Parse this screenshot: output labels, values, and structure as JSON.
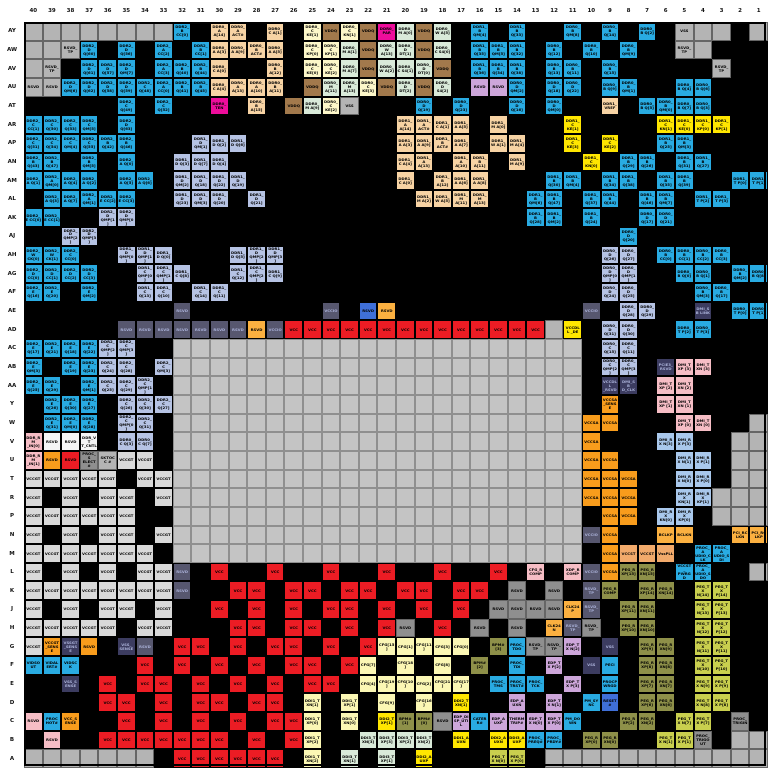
{
  "diagram": {
    "kind": "bga-ballout-map",
    "rows_count": 40,
    "columns_count": 40
  },
  "columns": [
    "40",
    "39",
    "38",
    "37",
    "36",
    "35",
    "34",
    "33",
    "32",
    "31",
    "30",
    "29",
    "28",
    "27",
    "26",
    "25",
    "24",
    "23",
    "22",
    "21",
    "20",
    "19",
    "18",
    "17",
    "16",
    "15",
    "14",
    "13",
    "12",
    "11",
    "10",
    "9",
    "8",
    "7",
    "6",
    "5",
    "4",
    "3",
    "2",
    "1"
  ],
  "row_labels": [
    "AY",
    "AW",
    "AV",
    "AU",
    "AT",
    "AR",
    "AP",
    "AN",
    "AM",
    "AL",
    "AK",
    "AJ",
    "AH",
    "AG",
    "AF",
    "AE",
    "AD",
    "AC",
    "AB",
    "AA",
    "Y",
    "W",
    "V",
    "U",
    "T",
    "R",
    "P",
    "N",
    "M",
    "L",
    "K",
    "J",
    "H",
    "G",
    "F",
    "E",
    "D",
    "C",
    "B",
    "A"
  ],
  "palette": {
    "K": "#000000",
    "G": "#b4b4b4",
    "D": "#c4c4c4",
    "B": "#29abe2",
    "P": "#b6c3e4",
    "T": "#f7d3a4",
    "N": "#a2794c",
    "M": "#ee0d9b",
    "C": "#fdf7c9",
    "E": "#d9ead9",
    "L": "#cda6da",
    "R": "#ec1c24",
    "Y": "#ffe600",
    "O": "#f89c1c",
    "o": "#f2aa6b",
    "S": "#57576f",
    "V": "#d9d9d9",
    "W": "#f5f5f5",
    "U": "#a9c8ec",
    "p": "#f6bdc5",
    "y": "#fbf7b4",
    "v": "#8e9049",
    "l": "#c9cf4e",
    "A": "#fbb040",
    "F": "#3c3c60",
    "b": "#3f6fd8",
    "X": "#8f8f8f"
  },
  "palette_meaning": {
    "K": "vss-ground-black",
    "G": "unused-gray",
    "D": "die-center-area",
    "B": "ddr-data-bright-blue",
    "P": "ddr-data-periwinkle",
    "T": "ddr-address-tan",
    "N": "vddq-brown",
    "M": "ddr-parity-magenta",
    "C": "ddr0-clock-cream",
    "E": "ddr-ca-mint",
    "L": "rsvd-lavender",
    "R": "vcc-red",
    "Y": "ddr1-clock-yellow",
    "O": "vccsa-orange",
    "o": "vccst-peach",
    "S": "vccio-slate",
    "V": "vccgt-lightgray",
    "W": "rsvd-white",
    "U": "dmi-rx-powder",
    "p": "dmi-tx-pink",
    "y": "cfg-ddi1-paleyellow",
    "v": "peg-rx-olive",
    "l": "peg-tx-yellowgreen",
    "A": "clock-amber",
    "F": "dark-navy",
    "b": "medium-blue",
    "X": "rsvd-darkgray"
  },
  "grid": [
    "G;G;G;G;G;G;G;G;B:DDR2_B CC[0];K;T:DDR0_A A[14];T:DDR0_A ACT#;K;T:DDR0_C A[1];K;C:DDR0_C KE[1];N:VDDQ;C:DDR0_C KN[1];N:VDDQ;M:DDR0_ PAR;E:DDR0_M A[0];N:VDDQ;E:DDR0_W A[5];K;B:DDR1_B QM[4];K;B:DDR1_B Q[33];K;K;B:DDR0_B QM[8];K;B:DDR0_B Q[14];K;B:DDR0_B Q[2];K;G:VSS;G;G;K;G",
    "G;G;G:RSVD_TP;B:DDR2_D Q[60];K;B:DDR2_D Q[56];K;B:DDR2_A CC[2];K;B:DDR2_B CC[1];T:DDR0_A A[3];T:DDR0_A A[9];T:DDR0_B ACT#;T:DDR0_A A[5];K;C:DDR0_C KP[0];C:DDR0_C KP[1];E:DDR0_M A[1];N:VDDQ;E:DDR0_W A[13];E:DDR0_D DT[1];N:VDDQ;E:DDR0_C S4[0];K;B:DDR1_B Q[35];B:DDR1_B QM[5];B:DDR1_B Q[32];K;B:DDR0_B Q[12];K;B:DDR0_B Q[10];K;B:DDR0_B QM[9];K;K;G:RSVD_TP;G;K;K;K",
    "G;G:RSVD_TP;K;B:DDR2_D Q[61];B:DDR2_D Q[57];B:DDR2_D QM[7];K;B:DDR2_A CC[3];B:DDR2_B Q[40];B:DDR2_B Q[44];T:DDR0_C A[0];K;K;T:DDR0_B A[12];K;C:DDR0_C KE[0];C:DDR0_C KE[2];E:DDR0_M A[7];N:VDDQ;E:DDR0_W A[2];E:DDR0_C S4[1];E:DDR0_D DT[0];N:VDDQ;K;B:DDR1_B Q[36];B:DDR1_B Q[34];B:DDR1_B Q[38];K;B:DDR0_B Q[13];B:DDR0_B Q[11];K;B:DDR0_B Q[15];K;K;K;K;K;G:RSVD_TP;K;K",
    "G:RSVD;G:RSVD;B:DDR2_D QM[6];B:DDR2_D Q[62];B:DDR2_D Q[58];B:DDR2_D Q[59];B:DDR2_C Q[48];B:DDR2_A CC[0];B:DDR2_B Q[41];B:DDR2_B Q[45];T:DDR0_C A[4];T:DDR0_A A[13];T:DDR0_A A[10];T:DDR0_B A[11];K;N:VDDQ;E:DDR0_M A[11];E:DDR0_M A[13];C:DDR0_C KE[3];N:VDDQ;E:DDR0_D DT[2];N:VDDQ;E:DDR0_D S4[2];K;L:RSVD;L:RSVD;B:DDR0_D QM[2];K;B:DDR0_D Q[18];B:DDR0_D Q[22];K;B:DDR0_B Q[9];B:DDR0_B QM[1];K;K;B:DDR0_B Q[4];B:DDR0_B Q[6];K;K;K",
    "K;K;K;K;K;B:DDR2_C Q[49];K;B:DDR2_C Q[52];K;K;M:DDR0_ TEN;K;T:DDR0_B A[15];K;N:VDDQ;E:DDR0_M A[9];C:DDR0_C KE[2];G:VSS;K;K;K;B:DDR0_D Q[19];K;B:DDR0_D Q[23];K;K;B:DDR0_D Q[16];K;B:DDR0_D QM[0];K;K;T:DDR1_ VREF;K;B:DDR0_B Q[5];B:DDR0_B QM[0];B:DDR0_B Q[7];B:DDR0_B Q[3];K;K;K",
    "B:DDR2_C CC[1];B:DDR2_C Q[50];B:DDR2_C Q[53];B:DDR2_C QM[5];K;B:DDR2_D Q[63];K;K;K;K;K;K;K;K;K;K;K;K;K;K;T:DDR1_A A[14];T:DDR1_A ACT#;T:DDR1_C A[1];T:DDR1_A A[5];K;T:DDR1_M A[0];K;K;K;Y:DDR1_C KE[1];K;K;K;K;Y:DDR1_C KN[1];Y:DDR1_C KE[0];Y:DDR1_C KP[0];Y:DDR1_C KP[1];K;K",
    "B:DDR2_C Q[51];B:DDR2_C Q[54];B:DDR2_C QM[4];B:DDR2_C Q[55];B:DDR2_B Q[42];B:DDR2_B Q[46];K;K;K;P:DDR1_D QM[1];P:DDR1_D Q[2];P:DDR1_D Q[6];K;K;K;K;K;K;K;K;T:DDR1_A A[3];T:DDR1_A A[9];T:DDR1_B ACT#;T:DDR1_A A[7];K;T:DDR1_W A[1];T:DDR1_M A[4];K;K;Y:DDR1_C KE[3];K;Y:DDR1_C KE[2];K;K;B:DDR1_B Q[25];B:DDR1_B QM[3];K;K;K;K",
    "B:DDR2_B Q[43];B:DDR2_B Q[47];K;B:DDR2_B QM[5];K;B:DDR2_A Q[0];K;K;P:DDR1_D Q[3];P:DDR1_D Q[7];P:DDR1_D Q[4];K;K;K;K;K;K;K;K;K;T:DDR1_C A[4];T:DDR1_A A[13];K;T:DDR1_A A[10];T:DDR1_B A[11];K;T:DDR1_M A[9];K;K;K;Y:DDR1_C KN[0];K;B:DDR1_B Q[29];B:DDR1_B Q[26];K;B:DDR1_B Q[31];B:DDR1_B Q[27];K;K;K",
    "B:DDR2_A Q[1];B:DDR2_A QM[0];B:DDR2_A Q[4];B:DDR2_A Q[2];K;B:DDR2_A Q[5];B:DDR2_A Q[6];K;P:DDR1_D QM[2];P:DDR1_D Q[18];P:DDR1_D Q[22];P:DDR1_D Q[19];K;K;K;K;K;K;K;K;T:DDR1_C A[0];K;T:DDR1_B A[12];T:DDR1_A A[6];T:DDR1_A A[8];K;K;K;B:DDR1_B Q[30];B:DDR1_B QM[4];K;B:DDR1_B Q[34];B:DDR1_B Q[38];K;B:DDR1_B Q[35];B:DDR1_B Q[39];K;K;B:DDR1_T P[0];B:DDR1_T P[1]",
    "K;B:DDR2_A Q[3];B:DDR2_A Q[7];B:DDR2_A QM[1];B:DDR2_E CC[2];B:DDR2_E CC[3];K;K;P:DDR1_D Q[23];P:DDR1_D QM[3];P:DDR1_D Q[20];K;P:DDR1_D Q[21];K;K;K;K;K;K;K;K;T:DDR1_M A[2];T:DDR1_W A[5];T:DDR1_M A[11];T:DDR1_M A[13];K;K;B:DDR1_B QM[6];B:DDR1_B Q[47];K;B:DDR1_B Q[37];B:DDR1_B Q[44];K;B:DDR1_B Q[46];B:DDR1_B QM[7];K;B:DDR1_T P[2];B:DDR1_T P[3];K;K",
    "B:DDR2_E CC[0];B:DDR2_E CC[1];K;K;P:DDR2_D QMP[1];P:DDR2_D QMP[0];K;K;K;K;K;K;K;K;K;K;K;K;K;K;K;K;K;K;K;K;K;B:DDR1_B Q[28];B:DDR1_B QM[2];K;B:DDR1_B Q[24];K;K;B:DDR0_D Q[17];B:DDR0_D Q[21];K;K;K;K;K",
    "K;K;P:DDR2_D QMP[2];P:DDR2_D QMP[3];K;K;K;K;K;K;K;K;K;K;K;K;K;K;K;K;K;K;K;K;K;K;K;K;K;K;K;K;B:DDR0_D Q[20];K;K;K;K;K;K;K",
    "B:DDR2_W CK[0];B:DDR2_W CK[1];B:DDR2_C CC[0];K;K;P:DDR1_D QMP[0];P:DDR1_D QMP[1];P:DDR1_D Q[0];K;K;K;P:DDR1_D Q[5];P:DDR1_D QMP[2];P:DDR1_D QMP[3];K;K;K;K;K;K;K;K;K;K;K;K;K;K;K;K;K;P:DDR0_D Q[26];P:DDR0_D Q[27];K;B:DDR0_B CC[0];B:DDR0_B CC[1];B:DDR0_B CC[2];B:DDR0_B CC[3];K;K",
    "B:DDR2_D CC[0];B:DDR2_D CC[1];B:DDR2_D CC[2];B:DDR2_D CC[3];K;K;P:DDR1_C QMP[0];P:DDR1_C QMP[1];P:DDR1_C Q[8];K;K;P:DDR1_C Q[12];P:DDR1_C QMP[2];P:DDR1_C Q[9];K;K;K;K;K;K;K;K;K;K;K;K;K;K;K;K;K;P:DDR0_D QMP[0];P:DDR0_D QMP[1];K;K;B:DDR0_B Q[0];B:DDR0_B Q[1];K;B:DDR0_B QM[2];B:DDR0_B Q[8]",
    "B:DDR2_E Q[16];B:DDR2_E Q[20];K;B:DDR2_E QM[2];K;K;P:DDR1_C Q[13];P:DDR1_C Q[10];K;P:DDR1_C Q[14];P:DDR1_C Q[11];K;K;K;K;K;K;K;K;K;K;K;K;K;K;K;K;K;K;K;K;P:DDR0_D Q[24];P:DDR0_D Q[25];K;K;K;B:DDR0_B QM[3];B:DDR0_B Q[17];K;K",
    "K;K;K;K;K;K;K;K;S:RSVD;K;K;K;K;K;K;K;S:VCCIO;K;b:RSVD;A:RSVD;K;K;K;K;K;K;K;K;K;K;S:VCCIO;K;P:DDR0_D Q[28];P:DDR0_D Q[29];K;K;F:DMI_SB LINK;K;B:DDR0_T P[0];B:DDR0_T P[1]",
    "K;K;K;K;K;S:RSVD;S:RSVD;S:RSVD;S:RSVD;S:RSVD;S:RSVD;S:RSVD;A:RSVD;S:VCCIO;R:VCC;R:VCC;R:VCC;R:VCC;R:VCC;R:VCC;R:VCC;R:VCC;R:VCC;R:VCC;R:VCC;R:VCC;R:VCC;R:VCC;G;Y:VCCDLL _DE;K;P:DDR0_D Q[31];P:DDR0_D Q[30];K;K;B:DDR0_T P[2];B:DDR0_T P[3];K;K;K",
    "B:DDR2_E Q[17];B:DDR2_E Q[21];B:DDR2_E Q[18];B:DDR2_E Q[22];P:DDR2_C QMP[2];P:DDR2_C QMP[3];K;K;D;D;D;D;D;D;D;D;D;D;D;D;D;D;D;D;D;D;D;D;D;D;K;P:DDR0_C Q[15];P:DDR0_C Q[11];K;K;K;K;K;K;K",
    "B:DDR2_E QM[3];K;B:DDR2_E Q[19];B:DDR2_E Q[23];P:DDR2_C Q[24];P:DDR2_C Q[28];K;P:DDR2_C QM[3];D;D;D;D;D;D;D;D;D;D;D;D;D;D;D;D;D;D;D;D;D;D;K;P:DDR0_C QMP[2];P:DDR0_C QMP[3];K;F:PCIE3_ RSVD;p:DMI_TXP [3];p:DMI_TXN [3];K;K;K",
    "B:DDR2_E Q[25];B:DDR2_E Q[29];K;B:DDR2_E QM[1];P:DDR2_C Q[25];P:DDR2_C Q[29];P:DDR2_C QMP[1];K;D;D;D;D;D;D;D;D;D;D;D;D;D;D;D;D;D;D;D;D;D;D;K;F:VCCDLL _RSVD;F:DMI_SB D_CLK;K;p:DMI_TXP [2];p:DMI_TXN [2];K;K;K;K",
    "K;B:DDR2_E Q[26];B:DDR2_E Q[30];B:DDR2_E Q[27];K;P:DDR2_C Q[26];P:DDR2_C Q[30];P:DDR2_C Q[27];D;D;D;D;D;D;D;D;D;D;D;D;D;D;D;D;D;D;D;D;D;D;K;O:VCCSA _SENSE;K;K;p:DMI_TXP [1];p:DMI_TXN [1];K;K;K;K",
    "K;B:DDR2_E Q[31];B:DDR2_E QM[0];B:DDR2_E Q[28];K;P:DDR2_C QMP[0];P:DDR2_C Q[31];K;D;D;D;D;D;D;D;D;D;D;D;D;D;D;D;D;D;D;D;D;D;D;O:VCCSA;O:VCCSA;K;K;K;p:DMI_TXP [0];p:DMI_TXN [0];K;K;G",
    "p:DDR_RM _IN[0];W:RSVD;W:RSVD;W:DDR_VT T_CNTL;K;P:DDR0_C Q[3];P:DDR0_C Q[7];K;D;D;D;D;D;D;D;D;D;D;D;D;D;D;D;D;D;D;D;D;D;D;O:VCCSA;K;K;K;U:DMI_RX N[3];U:DMI_RX P[3];K;K;G;G",
    "p:DDR_RM _IN[1];O:RSVD;R:RSVD;X:PROC_S ELECT#;G:SKTOCC #;V:VCCGT;V:VCCGT;K;D;D;D;D;D;D;D;D;D;D;D;D;D;D;D;D;D;D;D;D;D;D;O:VCCSA;O:VCCSA;K;K;K;U:DMI_RX N[1];U:DMI_RX P[1];K;G;G",
    "V:VCCGT;V:VCCGT;V:VCCGT;V:VCCGT;V:VCCGT;K;V:VCCGT;V:VCCGT;D;D;D;D;D;D;D;D;D;D;D;D;D;D;D;D;D;D;D;D;D;D;O:VCCSA;O:VCCSA;O:VCCSA;K;K;U:DMI_RX N[0];U:DMI_RX P[0];K;G;G",
    "V:VCCGT;K;V:VCCGT;K;V:VCCGT;V:VCCGT;K;V:VCCGT;D;D;D;D;D;D;D;D;D;D;D;D;D;D;D;D;D;D;D;D;D;D;O:VCCSA;O:VCCSA;O:VCCSA;K;K;U:DMI_RX KN[1];U:DMI_RX KP[1];G;G;G",
    "V:VCCGT;V:VCCGT;V:VCCGT;V:VCCGT;V:VCCGT;V:VCCGT;K;K;D;D;D;D;D;D;D;D;D;D;D;D;D;D;D;D;D;D;D;D;D;D;K;O:VCCSA;O:VCCSA;K;U:DMI_RX KN[0];U:DMI_RX KP[0];K;G;G;G",
    "V:VCCGT;K;V:VCCGT;K;V:VCCGT;V:VCCGT;K;V:VCCGT;D;D;D;D;D;D;D;D;D;D;D;D;D;D;D;D;D;D;D;D;D;D;S:VCCIO;O:VCCSA;K;K;A:BCLKP;A:BCLKN;K;K;A:PCI_RC LKN;A:PCI_RC LKP",
    "V:VCCGT;V:VCCGT;V:VCCGT;V:VCCGT;V:VCCGT;V:VCCGT;V:VCCGT;K;D;D;D;D;D;D;D;D;D;D;D;D;D;D;D;D;D;D;D;D;D;D;K;O:VCCSA;o:VCCST;o:VCCST;o:VssPLL;K;B:PROC_A UDIO_CLK;B:PROC_A UDIO_SDI;K;K",
    "V:VCCGT;K;V:VCCGT;K;V:VCCGT;K;V:VCCGT;V:VCCGT;S:RSVD;K;R:VCC;K;K;R:VCC;K;K;R:VCC;K;K;R:VCC;K;K;R:VCC;K;K;R:VCC;K;p:CFG_R COMP;K;p:XDP_R COMP;S:VCCIO;O:VCCSA;v:PEG_R XP[15];v:PEG_R XN[15];K;B:VCCST_ PWRGD;B:PROC_A UDIO_SDO;K;K;G",
    "V:VCCGT;V:VCCGT;V:VCCGT;V:VCCGT;V:VCCGT;V:VCCGT;V:VCCGT;V:VCCGT;S:RSVD;K;K;R:VCC;R:VCC;K;R:VCC;R:VCC;K;R:VCC;R:VCC;K;R:VCC;R:VCC;K;R:VCC;R:VCC;K;X:RSVD;K;X:RSVD;K;S:RSVD_ TP;v:PEG_R COMP;K;v:PEG_R XP[14];v:PEG_R XN[14];K;l:PEG_TX N[14];l:PEG_TX P[14];K;K",
    "V:VCCGT;K;V:VCCGT;K;V:VCCGT;V:VCCGT;K;V:VCCGT;K;K;R:VCC;K;R:VCC;K;R:VCC;K;R:VCC;R:VCC;K;R:VCC;K;R:VCC;K;R:VCC;K;X:RSVD;X:RSVD;X:RSVD;X:RSVD;A:CLK24P;S:RSVD_ TP;K;v:PEG_R XP[11];v:PEG_R XN[11];K;K;l:PEG_TX N[13];l:PEG_TX P[13];K;K",
    "V:VCCGT;V:VCCGT;V:VCCGT;V:VCCGT;V:VCCGT;K;V:VCCGT;V:VCCGT;K;K;K;R:VCC;R:VCC;K;R:VCC;R:VCC;K;R:VCC;K;R:VCC;X:RSVD;K;R:VCC;K;X:RSVD;K;X:RSVD;K;A:CLK24N;S:RSVD_ TP;X:RSVD_ TP;K;v:PEG_R XP[10];v:PEG_R XN[10];K;K;l:PEG_TX N[12];l:PEG_TX P[12];K;K",
    "V:VCCGT;O:VCCGT _SENSE;F:VSSGT _SENSE;O:RSVD;K;F:VSS_ SENSE;S:RSVD;K;R:VCC;R:VCC;K;R:VCC;K;R:VCC;R:VCC;K;R:VCC;K;R:VCC;y:CFG[15];y:CFG[1];y:CFG[11];y:CFG[3];y:CFG[0];K;v:BPM# [3];B:PROC_ TDO;X:RSVD_ TP;X:RSVD_ TP;L:EDP_TX N[2];K;F:VSS;K;v:PEG_R XP[9];v:PEG_R XN[9];K;l:PEG_TX N[11];l:PEG_TX P[11];K;K",
    "B:VIDSO UT;B:VIDAL ERT#;B:VIDSC K;K;K;K;R:VCC;K;R:VCC;K;R:VCC;K;R:VCC;K;R:VCC;R:VCC;K;R:VCC;y:CFG[7];K;y:CFG[18];K;y:CFG[8];K;v:BPM# [2];K;B:PROC_ TDI;K;L:EDP_TX P[2];K;F:VSS;B:PECI;K;v:PEG_R XP[8];v:PEG_R XN[8];K;l:PEG_TX N[10];l:PEG_TX P[10];K;K",
    "K;K;F:VSS_S ENSE;K;R:VCC;K;R:VCC;R:VCC;K;R:VCC;K;R:VCC;K;R:VCC;K;R:VCC;R:VCC;K;y:CFG[4];y:CFG[19];y:CFG[10];y:CFG[2];y:CFG[21];y:CFG[17];K;B:PROC_ TMS;B:PROC_ TRST#;B:PROC_ TCK;K;L:EDP_TX P[3];K;B:PROCP WRGD;K;v:PEG_R XP[7];v:PEG_R XN[7];K;l:PEG_TX N[9];l:PEG_TX P[9];K;K",
    "K;K;K;K;R:VCC;R:VCC;K;R:VCC;K;R:VCC;R:VCC;K;R:VCC;R:VCC;K;y:DDI1_T XN[1];K;y:DDI1_T XP[1];K;y:CFG[9];K;y:CFG[16];K;Y:DDI2_T XN[1];K;K;L:EDP_A UXN;K;L:EDP_TX N[1];K;B:PM_SY NC;b:RESET #;K;v:PEG_R XP[6];v:PEG_R XN[6];K;l:PEG_TX N[8];l:PEG_TX P[8];K;K",
    "p:RSVD;B:PROC HOT#;O:VCC_S ENSE;K;K;R:VCC;K;R:VCC;K;R:VCC;K;R:VCC;K;R:VCC;R:VCC;y:DDI1_T XP[0];K;y:DDI1_T XN[0];K;Y:DDI2_T XP[1];v:BPM# [1];v:BPM# [0];X:RSVD;L:EDP_DI SP_UTIL;B:CATER R#;L:EDP_A UXP;L:THERM TRIP#;L:EDP_TX N[0];L:EDP_TX P[0];B:PM_DO WN;K;K;v:PEG_R XP[2];v:PEG_R XN[2];K;l:PEG_TX N[7];l:PEG_TX P[7];K;X:PROC_ TRIGIN;K",
    "K;p:RSVD;K;K;R:VCC;R:VCC;R:VCC;R:VCC;R:VCC;R:VCC;R:VCC;K;R:VCC;K;R:VCC;y:DDI1_T XP[2];K;K;E:DDI3_T XN[3];E:DDI3_T XP[3];E:DDI3_T XP[2];E:DDI3_T XN[2];K;Y:DDI1_A UXN;K;Y:DDI2_A UXN;Y:DDI3_A UXP;B:PROC_ PREQ#;B:PROC_ PRDY#;K;v:PEG_R XP[0];v:PEG_R XN[0];K;K;l:PEG_TX N[1];l:PEG_TX P[1];X:PROC_ TRIGOUT;K;G;G",
    "G;G;G;G;G;G;G;K;R:VCC;R:VCC;R:VCC;R:VCC;R:VCC;R:VCC;K;y:DDI1_T XN[2];K;E:DDI3_T XN[1];K;E:DDI3_T XP[1];K;Y:DDI2_A UXP;K;K;K;l:PEG_TX N[0];l:PEG_TX P[0];K;G;G;G;G;G;G;G;G;G;G;G;G"
  ]
}
